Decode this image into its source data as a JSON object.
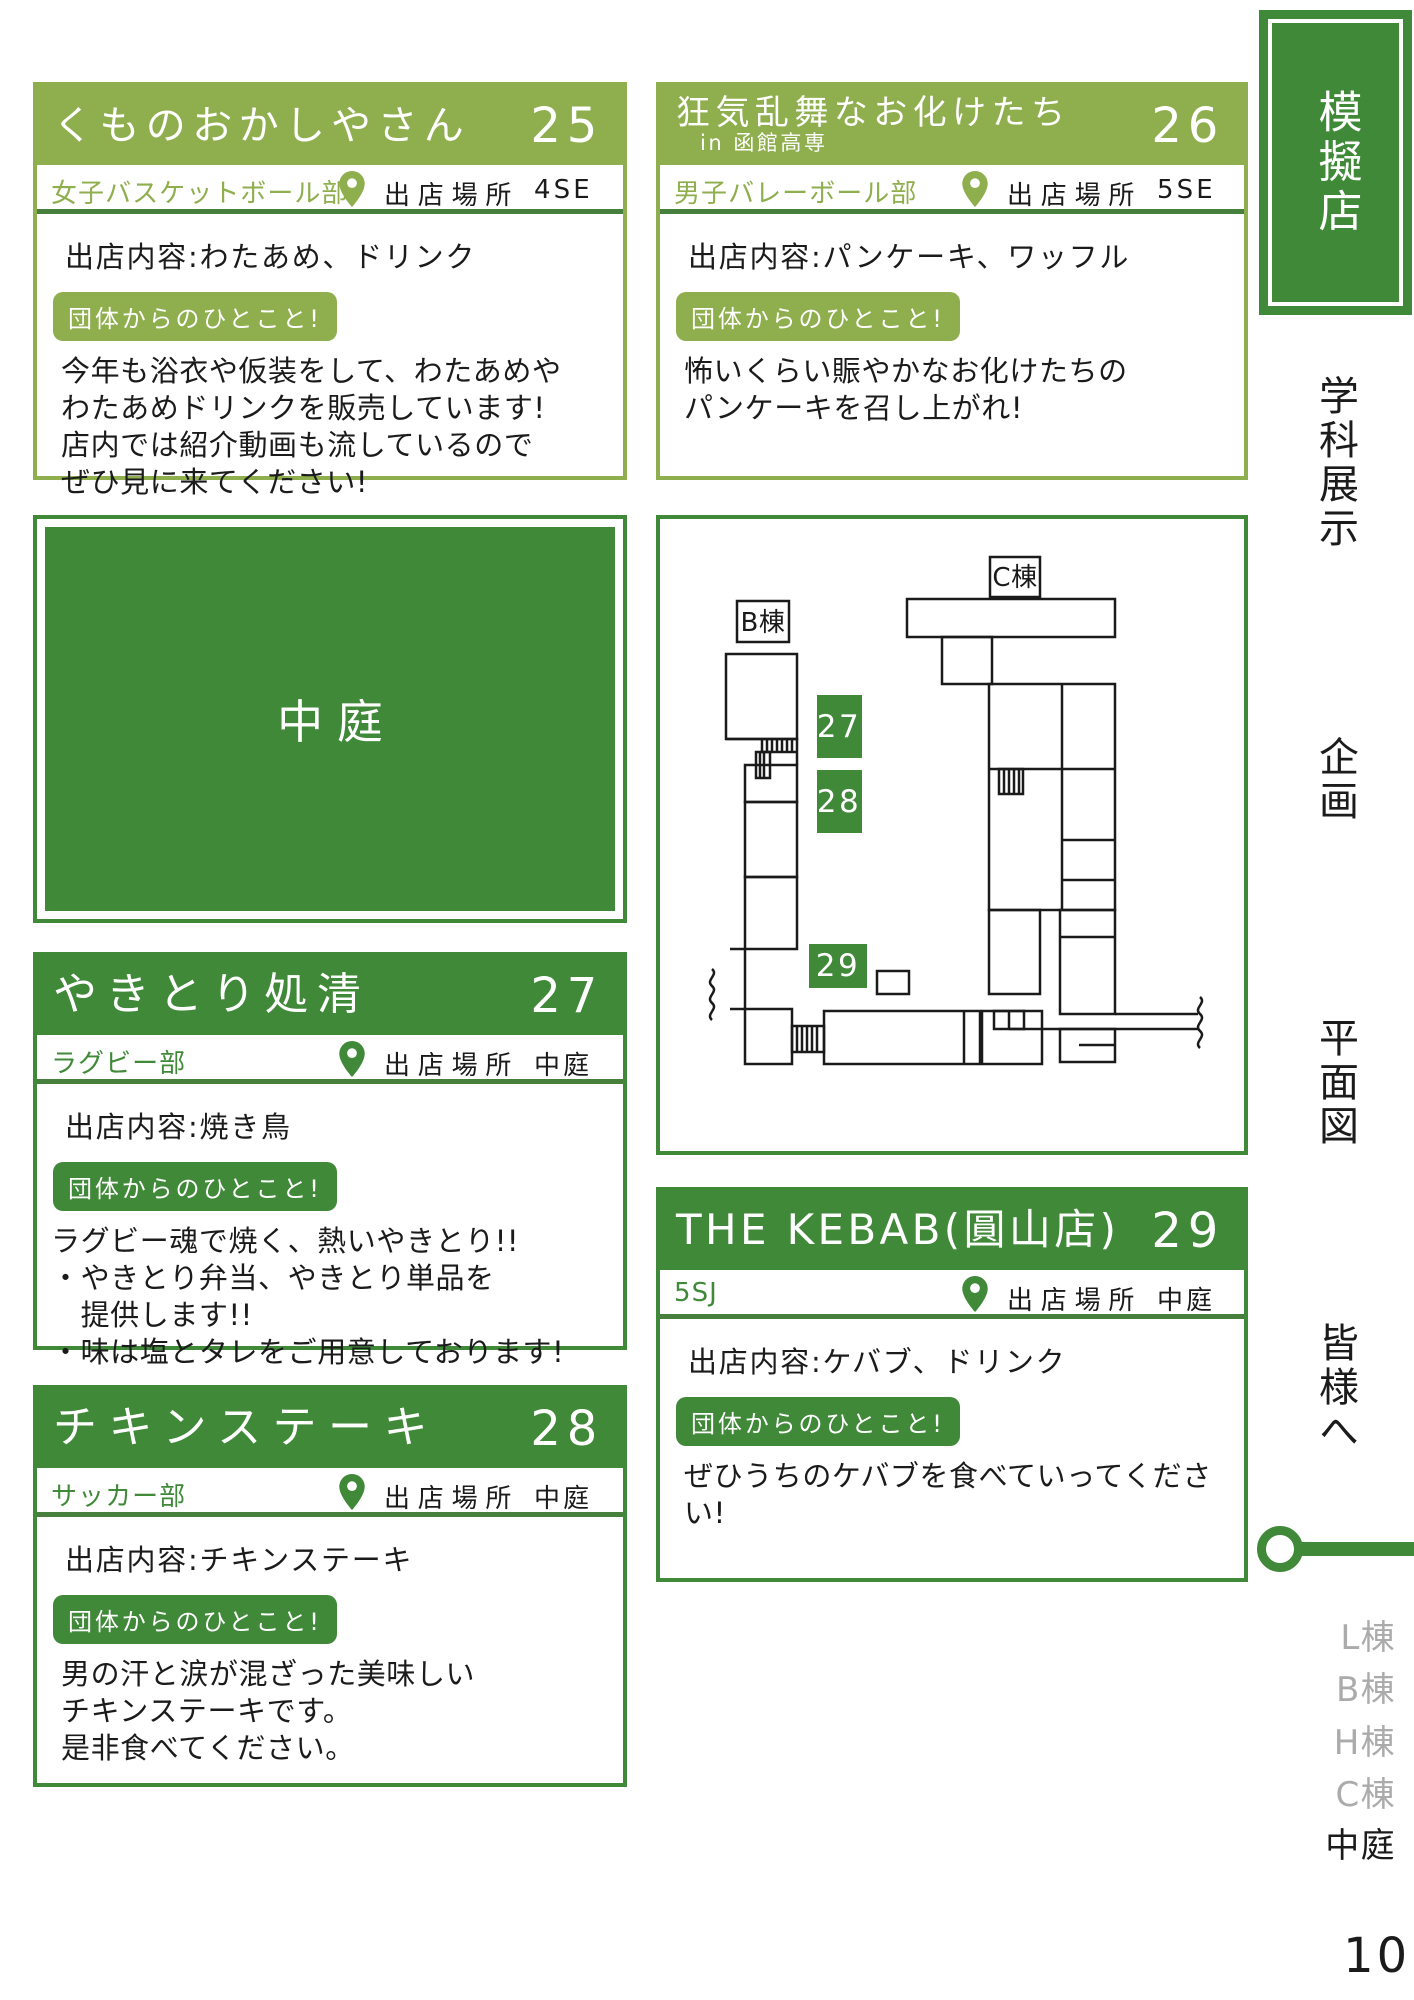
{
  "colors": {
    "light_green": "#8fae4d",
    "dark_green": "#3f8938",
    "divider_green": "#47803d",
    "inactive_gray": "#ababab"
  },
  "shared": {
    "location_label": "出店場所",
    "comment_badge": "団体からのひとこと!"
  },
  "cards": [
    {
      "title": "くものおかしやさん",
      "number": "25",
      "club": "女子バスケットボール部",
      "location": "4SE",
      "content_line": "出店内容:わたあめ、ドリンク",
      "comments": [
        "今年も浴衣や仮装をして、わたあめや",
        "わたあめドリンクを販売しています!",
        "店内では紹介動画も流しているので",
        "ぜひ見に来てください!"
      ]
    },
    {
      "title": "狂気乱舞なお化けたち",
      "subtitle": "in 函館高専",
      "number": "26",
      "club": "男子バレーボール部",
      "location": "5SE",
      "content_line": "出店内容:パンケーキ、ワッフル",
      "comments": [
        "怖いくらい賑やかなお化けたちの",
        "パンケーキを召し上がれ!"
      ]
    },
    {
      "title": "やきとり処清",
      "number": "27",
      "club": "ラグビー部",
      "location": "中庭",
      "content_line": "出店内容:焼き鳥",
      "comments": [
        "ラグビー魂で焼く、熱いやきとり!!",
        "・やきとり弁当、やきとり単品を",
        "　提供します!!",
        "・味は塩とタレをご用意しております!"
      ]
    },
    {
      "title": "チキンステーキ",
      "number": "28",
      "club": "サッカー部",
      "location": "中庭",
      "content_line": "出店内容:チキンステーキ",
      "comments": [
        "男の汗と涙が混ざった美味しい",
        "チキンステーキです。",
        "是非食べてください。"
      ]
    },
    {
      "title": "THE KEBAB(圓山店)",
      "number": "29",
      "club": "5SJ",
      "location": "中庭",
      "content_line": "出店内容:ケバブ、ドリンク",
      "comments": [
        "ぜひうちのケバブを食べていってください!"
      ]
    }
  ],
  "courtyard": {
    "label": "中庭"
  },
  "map": {
    "building_b": "B棟",
    "building_c": "C棟",
    "marker_27": "27",
    "marker_28": "28",
    "marker_29": "29"
  },
  "sidebar": {
    "current_tab": "模擬店",
    "tabs": [
      "学科展示",
      "企画",
      "平面図",
      "皆様へ"
    ],
    "buildings": [
      "L棟",
      "B棟",
      "H棟",
      "C棟",
      "中庭"
    ]
  },
  "page_number": "10"
}
